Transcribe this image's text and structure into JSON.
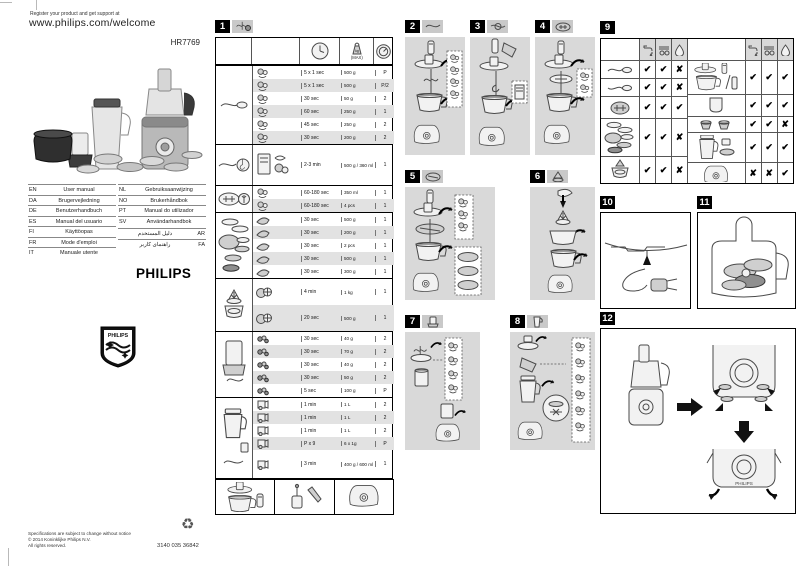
{
  "page": {
    "register_line": "Register your product and get support at",
    "welcome_url": "www.philips.com/welcome",
    "model": "HR7769"
  },
  "brand": {
    "wordmark": "PHILIPS",
    "shield_label": "PHILIPS"
  },
  "languages": {
    "left": [
      {
        "code": "EN",
        "label": "User manual"
      },
      {
        "code": "DA",
        "label": "Brugervejledning"
      },
      {
        "code": "DE",
        "label": "Benutzerhandbuch"
      },
      {
        "code": "ES",
        "label": "Manual del usuario"
      },
      {
        "code": "FI",
        "label": "Käyttöopas"
      },
      {
        "code": "FR",
        "label": "Mode d'emploi"
      },
      {
        "code": "IT",
        "label": "Manuale utente"
      }
    ],
    "right": [
      {
        "code": "NL",
        "label": "Gebruiksaanwijzing"
      },
      {
        "code": "NO",
        "label": "Brukerhåndbok"
      },
      {
        "code": "PT",
        "label": "Manual do utilizador"
      },
      {
        "code": "SV",
        "label": "Användarhandbok"
      }
    ],
    "rtl": [
      {
        "code": "AR",
        "label": "دليل المستخدم"
      },
      {
        "code": "FA",
        "label": "راهنمای کاربر"
      }
    ]
  },
  "footer": {
    "line1": "Specifications are subject to change without notice",
    "line2": "© 2014 Koninklijke Philips N.V.",
    "line3": "All rights reserved.",
    "part_number": "3140 035 36842"
  },
  "panels": {
    "p1": "1",
    "p2": "2",
    "p3": "3",
    "p4": "4",
    "p5": "5",
    "p6": "6",
    "p7": "7",
    "p8": "8",
    "p9": "9",
    "p10": "10",
    "p11": "11",
    "p12": "12"
  },
  "processing_table": {
    "max_label": "(MAX)",
    "groups": [
      {
        "tool": "blade-unit",
        "rows": [
          {
            "time": "5 x 1 sec",
            "amount": "500 g",
            "speed": "P"
          },
          {
            "time": "5 x 1 sec",
            "amount": "500 g",
            "speed": "P/2"
          },
          {
            "time": "30 sec",
            "amount": "50 g",
            "speed": "2"
          },
          {
            "time": "60 sec",
            "amount": "250 g",
            "speed": "1"
          },
          {
            "time": "45 sec",
            "amount": "250 g",
            "speed": "2"
          },
          {
            "time": "30 sec",
            "amount": "200 g",
            "speed": "2"
          }
        ]
      },
      {
        "tool": "kneading-accessory",
        "rows": [
          {
            "time": "2-3 min",
            "amount": "500 g / 360 ml",
            "speed": "1"
          }
        ]
      },
      {
        "tool": "emulsifying-disc",
        "rows": [
          {
            "time": "60-180 sec",
            "amount": "350 ml",
            "speed": "1"
          },
          {
            "time": "60-180 sec",
            "amount": "4 pcs",
            "speed": "1"
          }
        ]
      },
      {
        "tool": "inserts-discs",
        "rows": [
          {
            "time": "30 sec",
            "amount": "500 g",
            "speed": "1"
          },
          {
            "time": "30 sec",
            "amount": "200 g",
            "speed": "1"
          },
          {
            "time": "30 sec",
            "amount": "2 pcs",
            "speed": "1"
          },
          {
            "time": "30 sec",
            "amount": "500 g",
            "speed": "1"
          },
          {
            "time": "30 sec",
            "amount": "300 g",
            "speed": "1"
          }
        ]
      },
      {
        "tool": "citrus-press",
        "rows": [
          {
            "time": "4 min",
            "amount": "1 kg",
            "speed": "1"
          },
          {
            "time": "20 sec",
            "amount": "500 g",
            "speed": "1"
          }
        ]
      },
      {
        "tool": "mini-chopper",
        "rows": [
          {
            "time": "30 sec",
            "amount": "40 g",
            "speed": "2"
          },
          {
            "time": "30 sec",
            "amount": "70 g",
            "speed": "2"
          },
          {
            "time": "30 sec",
            "amount": "40 g",
            "speed": "2"
          },
          {
            "time": "30 sec",
            "amount": "50 g",
            "speed": "2"
          },
          {
            "time": "5 sec",
            "amount": "100 g",
            "speed": "P"
          }
        ]
      },
      {
        "tool": "blender",
        "rows": [
          {
            "time": "1 min",
            "amount": "1 L",
            "speed": "2"
          },
          {
            "time": "1 min",
            "amount": "1 L",
            "speed": "2"
          },
          {
            "time": "1 min",
            "amount": "1 L",
            "speed": "2"
          },
          {
            "time": "P x 9",
            "amount": "6 x 1g",
            "speed": "P"
          },
          {
            "time": "3 min",
            "amount": "400 g / 600 ml",
            "speed": "1"
          }
        ]
      }
    ]
  },
  "cleaning_table": {
    "left_rows": [
      {
        "item": "blade-unit",
        "marks": [
          "✔",
          "✔",
          "✘"
        ]
      },
      {
        "item": "kneading-accessory",
        "marks": [
          "✔",
          "✔",
          "✘"
        ]
      },
      {
        "item": "emulsifying-disc",
        "marks": [
          "✔",
          "✔",
          "✔"
        ]
      },
      {
        "item": "inserts-discs",
        "marks": [
          "✔",
          "✔",
          "✘"
        ]
      },
      {
        "item": "citrus-press",
        "marks": [
          "✔",
          "✔",
          "✘"
        ]
      }
    ],
    "right_rows": [
      {
        "item": "bowl-lid-pusher-spatula",
        "marks": [
          "✔",
          "✔",
          "✔"
        ]
      },
      {
        "item": "chopper-beaker",
        "marks": [
          "✔",
          "✔",
          "✔"
        ]
      },
      {
        "item": "tool-holders",
        "marks": [
          "✔",
          "✔",
          "✘"
        ]
      },
      {
        "item": "blender-jar-set",
        "marks": [
          "✔",
          "✔",
          "✔"
        ]
      },
      {
        "item": "motor-unit",
        "marks": [
          "✘",
          "✘",
          "✔"
        ]
      }
    ]
  }
}
